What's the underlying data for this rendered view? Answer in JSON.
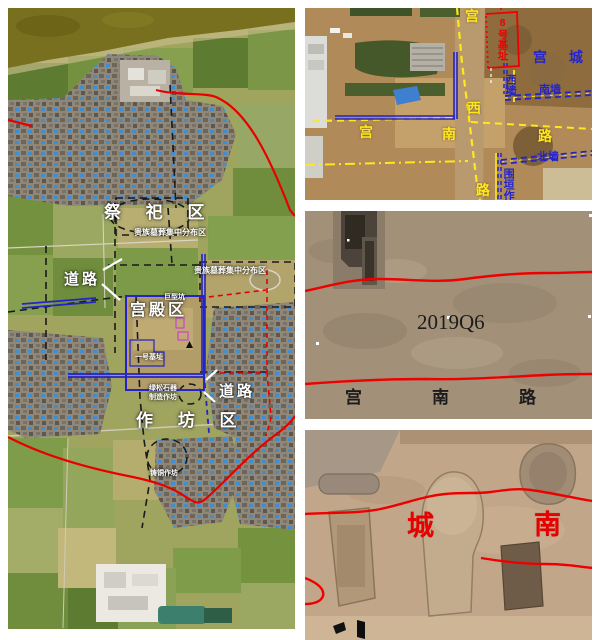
{
  "figure": {
    "colors": {
      "annotation_red": "#e80000",
      "annotation_blue": "#2424c8",
      "annotation_yellow": "#ffe81a",
      "annotation_black": "#1a1a1a",
      "label_white": "#ffffff"
    },
    "site_map": {
      "zones": {
        "sacrificial": "祭 祀 区",
        "palace": "宫殿区",
        "workshop": "作 坊 区"
      },
      "labels": {
        "road_nw": "道路",
        "road_se": "道路",
        "noble_tombs_a": "贵族墓葬集中分布区",
        "noble_tombs_b": "贵族墓葬集中分布区",
        "giant_pit": "巨型坑",
        "foundation_one": "一号基址",
        "turquoise_line1": "绿松石器",
        "turquoise_line2": "制造作坊",
        "bronze_workshop": "铸铜作坊"
      }
    },
    "palace_aerial": {
      "road_vertical_top": "宫",
      "road_vertical_mid": "西",
      "road_vertical_bottom": "路",
      "road_horizontal_left": "宫",
      "road_horizontal_mid": "南",
      "road_horizontal_right": "路",
      "foundation_8": "8号基址",
      "palace_city": "宫 城",
      "west_wall": "西墙",
      "south_wall": "南墙",
      "north_wall": "北墙",
      "enclosure_workshop": "围垣作"
    },
    "trench_photo": {
      "trench_id": "2019Q6",
      "road_label": "宫南路"
    },
    "pits_photo": {
      "label_left": "城",
      "label_right": "南"
    }
  }
}
